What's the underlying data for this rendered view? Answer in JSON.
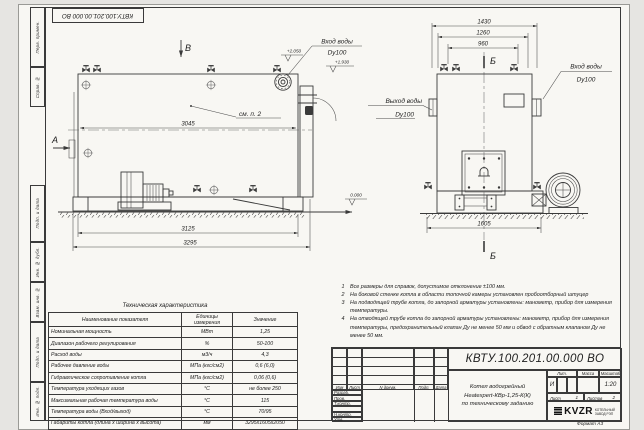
{
  "doc_number": "КВТУ.100.201.00.000 ВО",
  "format_note": "Формат А3",
  "colors": {
    "paper": "#f8f7f3",
    "background": "#e6e5e2",
    "line": "#3a3a3a"
  },
  "margins": {
    "labels": [
      "Перв. примен.",
      "Справ. №",
      "Подп. и дата",
      "Инв. № дубл.",
      "Взам. инв. №",
      "Подп. и дата",
      "Инв. № подл."
    ]
  },
  "side_view": {
    "label_a": "А",
    "label_b": "В",
    "see_note": "см. п. 2",
    "dim_shell": "3045",
    "dim_frame": "3125",
    "dim_overall": "3295",
    "elev_inlet": "+2.050",
    "elev_outlet": "+1.930",
    "elev_zero": "0.000",
    "inlet_line1": "Вход воды",
    "inlet_line2": "Dy100"
  },
  "front_view": {
    "label_section": "Б",
    "dim_overall": "1430",
    "dim_flanges": "1260",
    "dim_valves": "960",
    "dim_base": "1605",
    "outlet_line1": "Выход воды",
    "outlet_line2": "Dy100",
    "inlet_line1": "Вход воды",
    "inlet_line2": "Dy100"
  },
  "notes": [
    {
      "num": "1",
      "text": "Все размеры для справок, допустимое отклонение ±100 мм."
    },
    {
      "num": "2",
      "text": "На боковой стенке котла в области топочной камеры установлен пробоотборный штуцер"
    },
    {
      "num": "3",
      "text": "На подводящей трубе котла, до запорной арматуры установлены: манометр, прибор для измерения температуры."
    },
    {
      "num": "4",
      "text": "На отводящей трубе котла до запорной арматуры установлены: манометр, прибор для измерения температуры, предохранительный клапан Ду не менее 50 мм и обвод с обратным клапаном Ду не менее 50 мм."
    }
  ],
  "spec_table": {
    "title": "Техническая характеристика",
    "headers": [
      "Наименование показателя",
      "Единицы измерения",
      "Значение"
    ],
    "rows": [
      [
        "Номинальная мощность",
        "МВт",
        "1,25"
      ],
      [
        "Диапазон рабочего регулирования",
        "%",
        "50-100"
      ],
      [
        "Расход воды",
        "м3/ч",
        "4,3"
      ],
      [
        "Рабочее давление воды",
        "МПа (кгс/см2)",
        "0,6 (6,0)"
      ],
      [
        "Гидравлическое сопротивление котла",
        "МПа (кгс/см2)",
        "0,06 (0,6)"
      ],
      [
        "Температура уходящих газов",
        "°С",
        "не более 250"
      ],
      [
        "Максимальная рабочая температура воды",
        "°С",
        "115"
      ],
      [
        "Температура воды (Вход/выход)",
        "°С",
        "70/95"
      ],
      [
        "Габариты котла (длина х ширина х высота)",
        "мм",
        "3295х1605х2050"
      ]
    ]
  },
  "title_block": {
    "rev_headers": {
      "izm": "Изм",
      "list": "Лист",
      "doc": "N докум.",
      "sign": "Подп.",
      "date": "Дата"
    },
    "roles": [
      "Разраб.",
      "Пров.",
      "Т.контр.",
      "",
      "Н.контр.",
      "Утв."
    ],
    "product_line1": "Котел водогрейный",
    "product_line2": "Heatexpert-КВр-1,25-К(К)",
    "product_line3": "по техническому заданию",
    "lit_label": "Лит.",
    "mass_label": "Масса",
    "scale_label": "Масштаб",
    "lit_value": "И",
    "scale_value": "1:20",
    "sheet_label": "Лист",
    "sheet_value": "1",
    "sheets_label": "Листов",
    "sheets_value": "2",
    "logo_text": "KVZR",
    "logo_sub1": "КОТЕЛЬНЫЙ",
    "logo_sub2": "ЗАВОД РЭП"
  }
}
